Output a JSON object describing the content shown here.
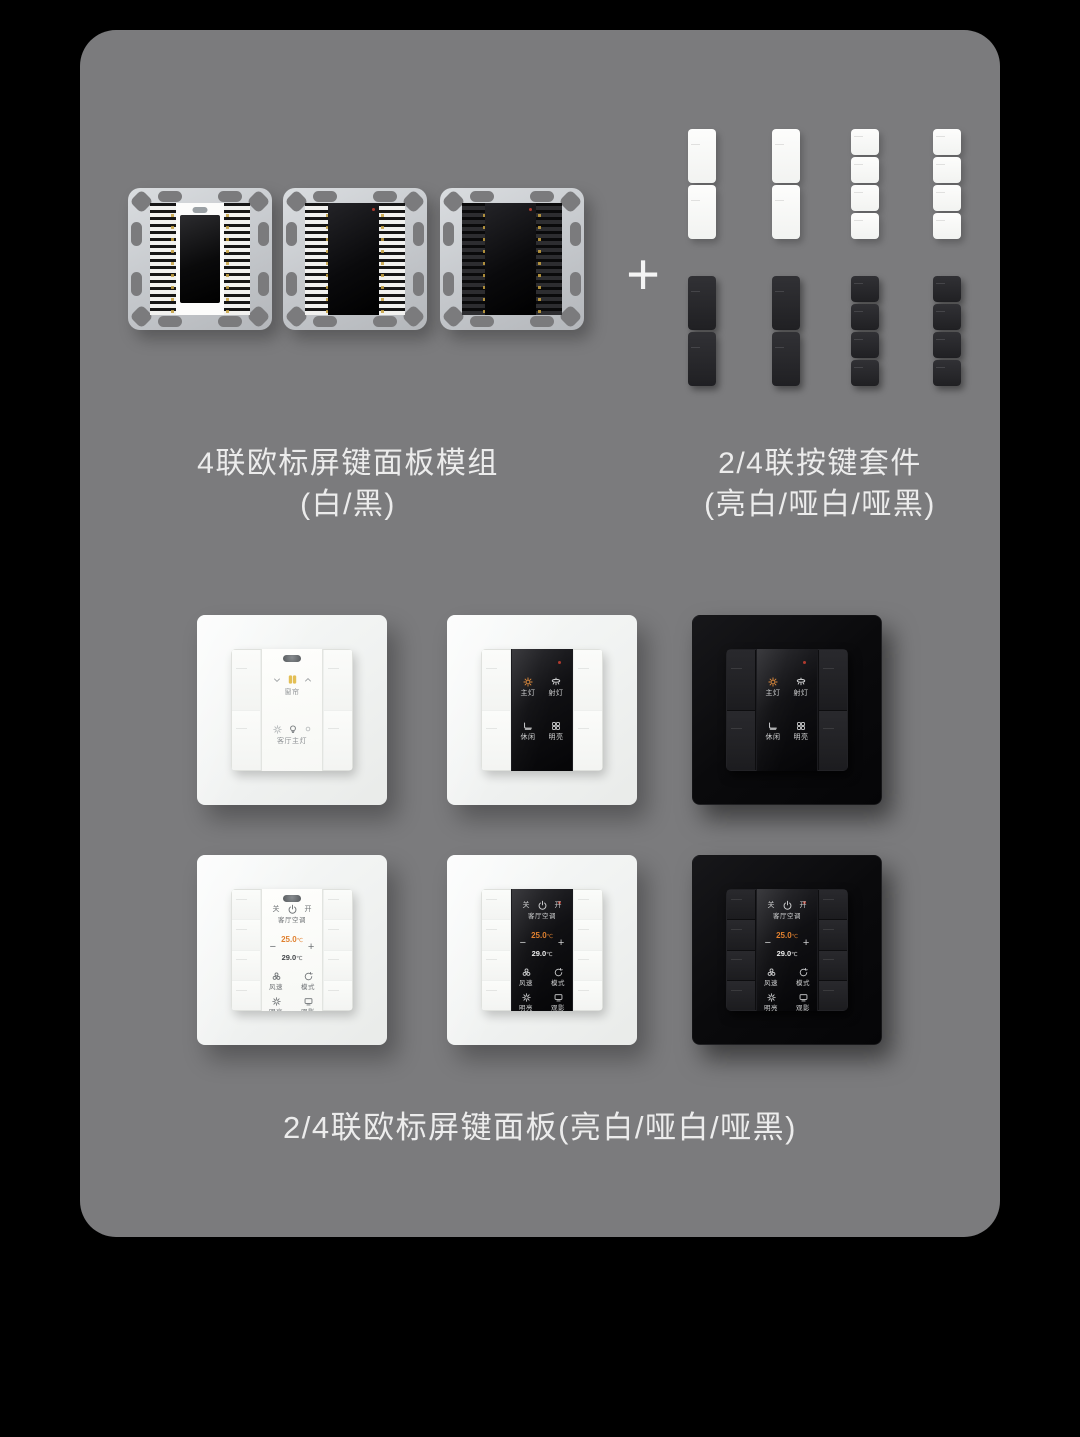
{
  "colors": {
    "page_background": "#000000",
    "card_gray": "#7b7b7d",
    "accent_orange": "#e0802f",
    "curtain_yellow": "#e3bf55",
    "indicator_red": "#b03a2e"
  },
  "top_section": {
    "plus": "+",
    "modules_caption": {
      "line1": "4联欧标屏键面板模组",
      "line2": "(白/黑)"
    },
    "keys_caption": {
      "line1": "2/4联按键套件",
      "line2": "(亮白/哑白/哑黑)"
    }
  },
  "screens": {
    "scene2": {
      "curtain_label": "窗帘",
      "light_label": "客厅主灯"
    },
    "scene4": {
      "main_light": "主灯",
      "spot_light": "射灯",
      "leisure": "休闲",
      "bright": "明亮"
    },
    "thermostat": {
      "off": "关",
      "on": "开",
      "title": "客厅空调",
      "minus": "−",
      "plus": "+",
      "set_temp": "25.0",
      "set_unit": "℃",
      "room_temp": "29.0",
      "room_unit": "℃",
      "fan": "风速",
      "mode": "模式",
      "bright": "明亮",
      "movie": "观影"
    }
  },
  "bottom_caption": "2/4联欧标屏键面板(亮白/哑白/哑黑)"
}
